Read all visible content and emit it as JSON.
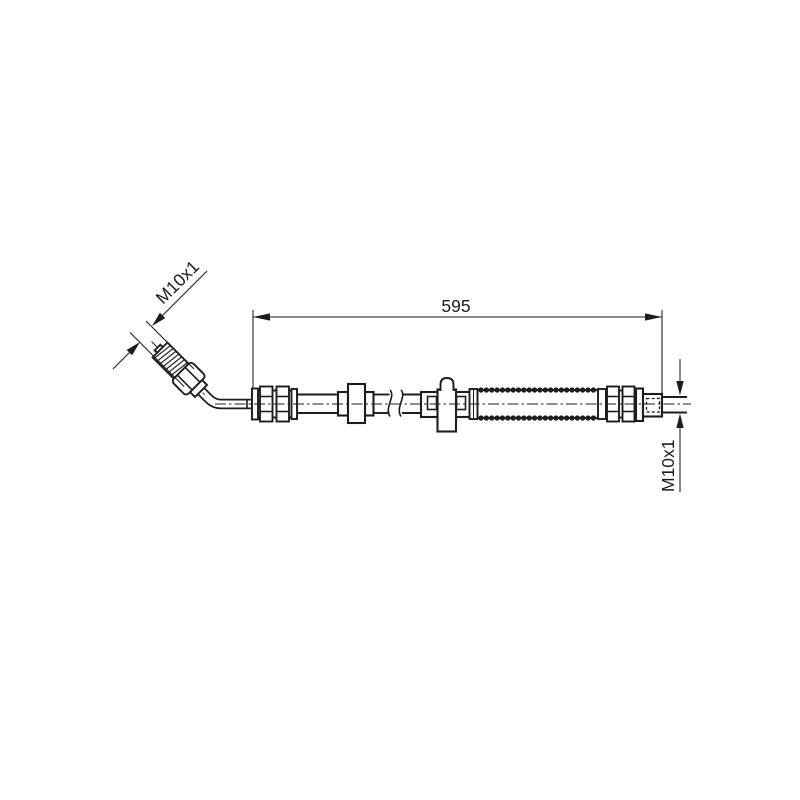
{
  "colors": {
    "background": "#ffffff",
    "line": "#1d1d1d"
  },
  "drawing": {
    "type": "technical-line-drawing",
    "labels": {
      "length_dimension": "595",
      "left_thread": "M10x1",
      "right_thread": "M10x1"
    }
  }
}
